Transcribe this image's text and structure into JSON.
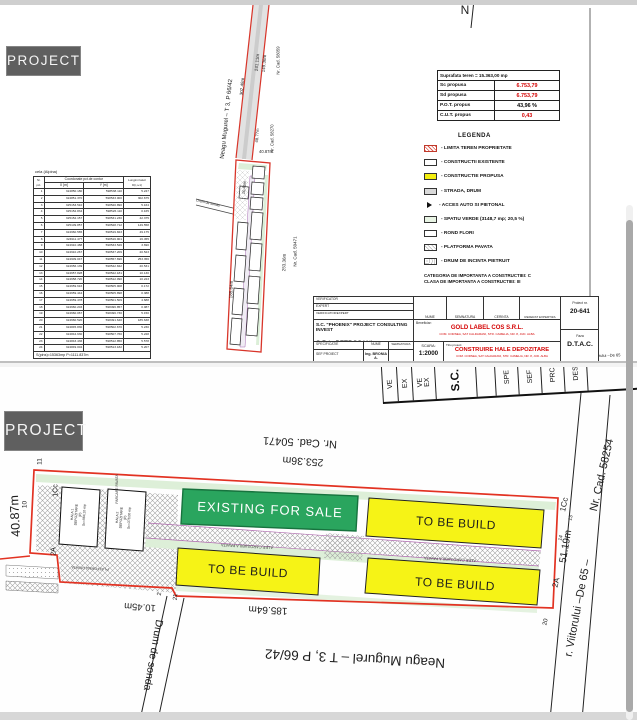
{
  "badge": "PROJECT",
  "top": {
    "north": "N",
    "road": "Neagu Mugurel  –  T 3, P 66/42",
    "dims": {
      "d30248": "302.48m",
      "d24111": "241.11m",
      "d14936": "149.36m",
      "d4877": "48.77m",
      "d4087": "40.87m",
      "d1045": "10.45m",
      "d25336": "253.36m",
      "d18564": "185.64m"
    },
    "cads": {
      "c58059": "Nr. Cad. 58059",
      "c58270": "Nr. Cad. 58270",
      "c50471": "Nr. Cad. 50471"
    },
    "drum": "Drum de sonda",
    "strv": "Str. Viitorului –De 65",
    "stats": {
      "row0": "Suprafata teren = 15.363,00 mp",
      "sc_label": "Sc propusa",
      "sc": "6.753,79",
      "sd_label": "Sd propusa",
      "sd": "6.753,79",
      "pot_label": "P.O.T. propus",
      "pot": "43,96 %",
      "cut_label": "C.U.T. propus",
      "cut": "0,43"
    },
    "legend": {
      "title": "LEGENDA",
      "items": [
        {
          "label": "- LIMITA TEREN PROPRIETATE"
        },
        {
          "label": "- CONSTRUCTII EXISTENTE"
        },
        {
          "label": "- CONSTRUCTIE PROPUSA"
        },
        {
          "label": "- STRADA, DRUM"
        },
        {
          "label": "- ACCES AUTO SI PIETONAL"
        },
        {
          "label": "- SPATIU VERDE (3148,7 mp;  20,5 %)"
        },
        {
          "label": "- ROND FLORI"
        },
        {
          "label": "- PLATFORMA PAVATA"
        },
        {
          "label": "- DRUM DE INCINTA PIETRUIT"
        }
      ],
      "cat1": "CATEGORIA DE IMPORTANTA A CONSTRUCTIEI: C",
      "cat2": "CLASA DE IMPORTANTA A CONSTRUCTIEI: III"
    },
    "table": {
      "title": "cela (Alpina)",
      "h_nr": "Nr. pct.",
      "h_coord": "Coordonate pct.de contur",
      "h_x": "X [m]",
      "h_y": "Y [m]",
      "h_len": "Lungimi laturi D(i,i+1)",
      "rows": [
        [
          "1",
          "324850.180",
          "598538.110",
          "5.247"
        ],
        [
          "2",
          "324851.370",
          "598533.000",
          "302.675"
        ],
        [
          "3",
          "325153.510",
          "598520.890",
          "5.164"
        ],
        [
          "4",
          "325152.834",
          "598526.110",
          "0.165"
        ],
        [
          "5",
          "325152.157",
          "598531.230",
          "42.375"
        ],
        [
          "6",
          "325109.857",
          "598528.712",
          "149.558"
        ],
        [
          "7",
          "324960.565",
          "598519.823",
          "49.175"
        ],
        [
          "8",
          "324911.477",
          "598516.901",
          "16.455"
        ],
        [
          "9",
          "324910.488",
          "598533.526",
          "3.690"
        ],
        [
          "10",
          "324910.267",
          "598537.209",
          "20.523"
        ],
        [
          "11",
          "324909.047",
          "598557.696",
          "253.356"
        ],
        [
          "12",
          "324656.139",
          "598542.842",
          "20.531"
        ],
        [
          "13",
          "324657.828",
          "598522.181",
          "10.130"
        ],
        [
          "14",
          "324658.720",
          "598512.090",
          "10.223"
        ],
        [
          "15",
          "324659.616",
          "598505.908",
          "0.172"
        ],
        [
          "16",
          "324659.444",
          "598505.898",
          "0.388"
        ],
        [
          "17",
          "324659.478",
          "598501.509",
          "4.688"
        ],
        [
          "18",
          "324660.203",
          "598496.857",
          "0.087"
        ],
        [
          "19",
          "324660.067",
          "598496.730",
          "5.150"
        ],
        [
          "20",
          "324660.520",
          "598491.640",
          "185.638"
        ],
        [
          "21",
          "324845.830",
          "598502.670",
          "5.230"
        ],
        [
          "22",
          "324844.630",
          "598507.760",
          "5.228"
        ],
        [
          "23",
          "324843.436",
          "598512.850",
          "5.578"
        ],
        [
          "24",
          "324849.004",
          "598513.182",
          "5.207"
        ]
      ],
      "footer": "S(pins)=15363mp    P=1111.837m"
    },
    "tb": {
      "verificator": "VERIFICATOR",
      "expert": "EXPERT",
      "verif_expert": "VERIFICATOR/EXPERT",
      "nume": "NUME",
      "semnatura": "SEMNATURA",
      "cerinta": "CERINTA",
      "referat": "REFERAT EXPERTIZA NR./DATA",
      "firm1": "S.C. \"PHOENIX\" PROJECT CONSULTING INVEST",
      "firm2": "S.R.L. PETROSANI",
      "firm3": "J20/746/2014; CUI 33619014",
      "beneficiar_label": "Beneficiar:",
      "beneficiar": "GOLD LABEL COS S.R.L.",
      "beneficiar_addr": "COM. CORNEA, SAT CALDARANI, STR. CAMELIA, NR. 8, JUD. ALBA",
      "proiect_label": "Proiect nr.",
      "proiect_nr": "20-641",
      "specificatie": "SPECIFICATIE",
      "nume2": "NUME",
      "semnatura2": "SEMNATURA",
      "sef": "SEF PROIECT",
      "sef_nume": "Ing. BRONIA A.",
      "scara_label": "SCARA:",
      "scara": "1:2000",
      "titlu_label": "Titlu proiect:",
      "titlu": "CONSTRUIRE HALE DEPOZITARE",
      "titlu_addr": "COM. CORNEA, SAT CALDARANI, STR. CAMELIA, NR. 8, JUD. ALBA",
      "faza_label": "Faza",
      "faza": "D.T.A.C."
    }
  },
  "bottom": {
    "strip": [
      "VE",
      "EX",
      "VE",
      "EX",
      "S.C.",
      "SPE",
      "SEF",
      "PRC",
      "DES"
    ],
    "labels": {
      "cad50471": "Nr. Cad. 50471",
      "d25336": "253.36m",
      "existing": "EXISTING FOR SALE",
      "tobebuild": "TO BE BUILD",
      "alee": "ALEE CAROSABILA PAVATA",
      "d18564": "185.64m",
      "d4087": "40.87m",
      "d1045": "10.45m",
      "d5119": "51.19m",
      "neagu": "Neagu Mugurel  –  T 3,  P 66/42",
      "drum": "Drum de sonda",
      "viitorului": "r. Viitorului  –De 65  –",
      "cad58254": "Nr. Cad. 58254",
      "hala1": [
        "HALA 1",
        "DEPOZITARE",
        "(P)",
        "Sc=984,10 mp"
      ],
      "hala2": [
        "HALA 2",
        "DEPOZITARE",
        "(P)",
        "Sc=378,00 mp"
      ],
      "platforma": "PLATFORMA PAVATA",
      "parcare": "PARCARE PAVATA",
      "v11": "11",
      "v10": "10",
      "v2a": "2A",
      "v1cc": "1Cc",
      "v13": "13",
      "v14": "14",
      "v20": "20",
      "v21": "21",
      "v2": "2"
    }
  }
}
